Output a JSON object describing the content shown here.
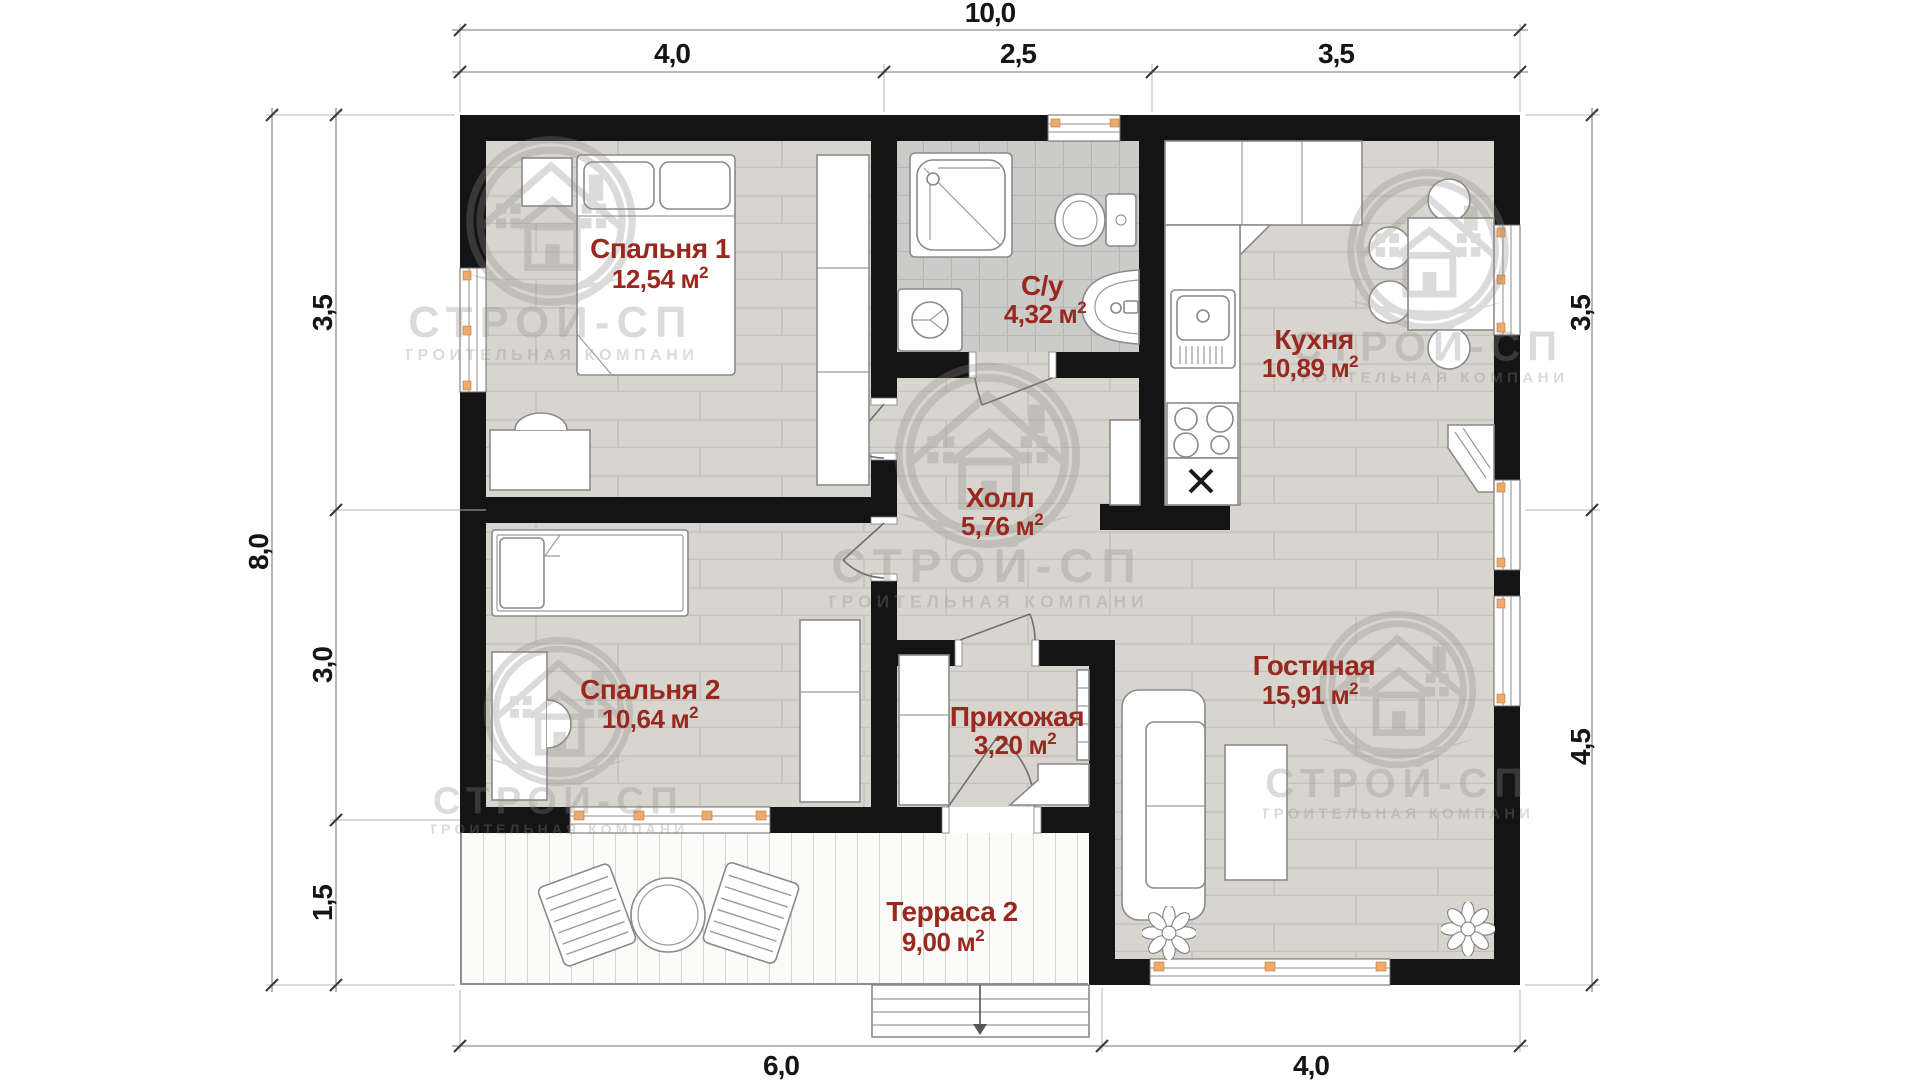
{
  "brand": {
    "name": "СТРОЙ-СП",
    "subtitle": "СТРОИТЕЛЬНАЯ КОМПАНИЯ"
  },
  "dimensions": {
    "top_total": "10,0",
    "top_segments": [
      "4,0",
      "2,5",
      "3,5"
    ],
    "left_total": "8,0",
    "left_segments": [
      "3,5",
      "3,0",
      "1,5"
    ],
    "right_segments": [
      "3,5",
      "4,5"
    ],
    "bottom_segments": [
      "6,0",
      "4,0"
    ]
  },
  "area_unit": {
    "unit": "м",
    "exp": "2"
  },
  "rooms": {
    "bedroom1": {
      "name": "Спальня 1",
      "area": "12,54"
    },
    "bathroom": {
      "name": "С/у",
      "area": "4,32"
    },
    "kitchen": {
      "name": "Кухня",
      "area": "10,89"
    },
    "hall": {
      "name": "Холл",
      "area": "5,76"
    },
    "bedroom2": {
      "name": "Спальня 2",
      "area": "10,64"
    },
    "entry": {
      "name": "Прихожая",
      "area": "3,20"
    },
    "living": {
      "name": "Гостиная",
      "area": "15,91"
    },
    "terrace": {
      "name": "Терраса 2",
      "area": "9,00"
    }
  },
  "colors": {
    "label_red": "#99291f",
    "wall_black": "#141414",
    "window_accent": "#efa96b",
    "floor_plank": "#d8d4ce",
    "floor_tile": "#cbcbc9"
  }
}
